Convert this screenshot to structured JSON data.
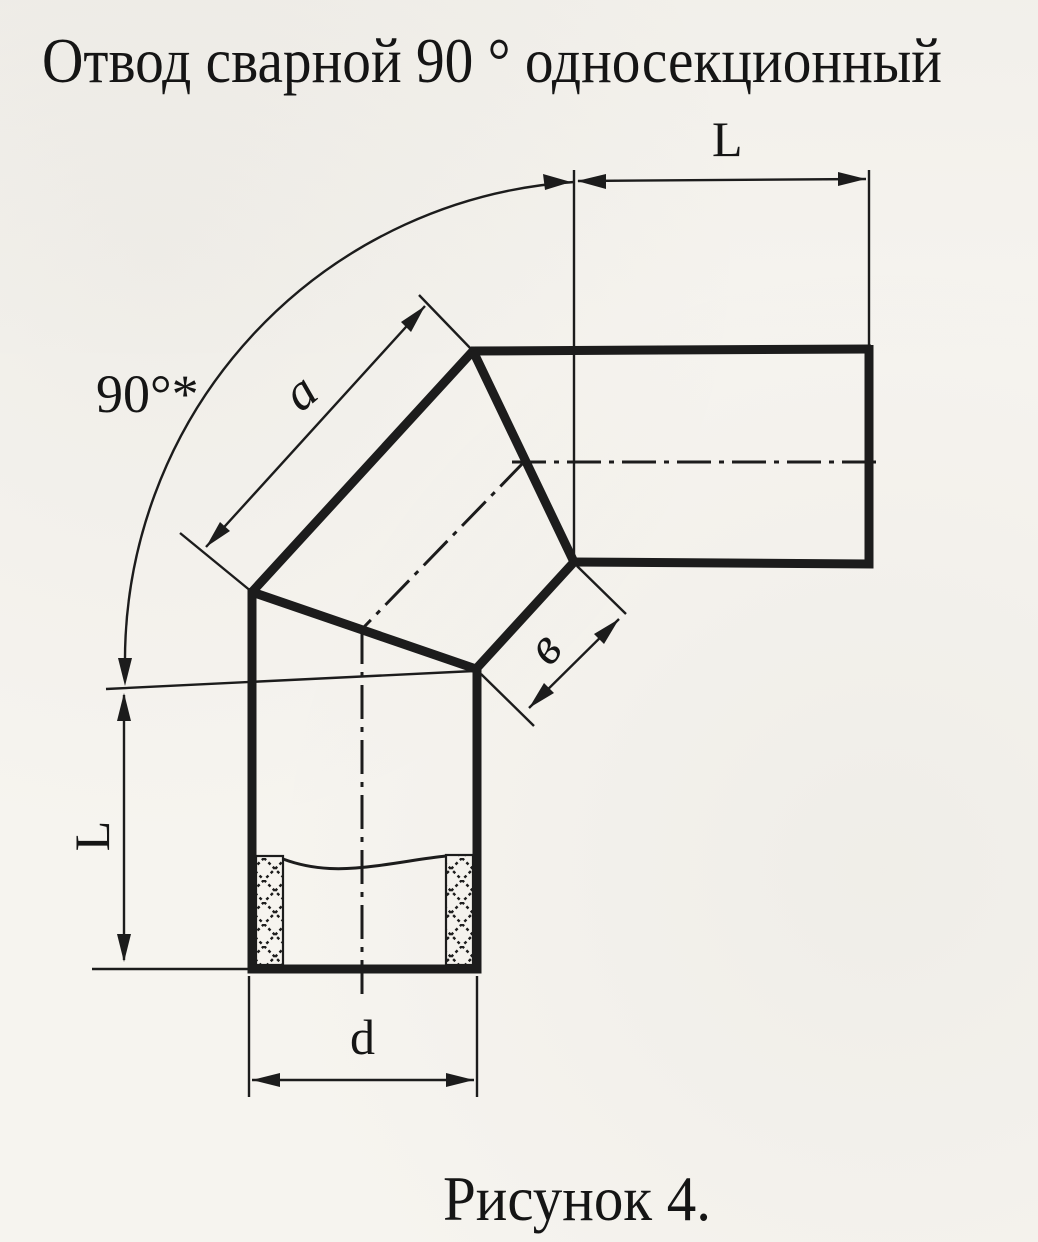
{
  "page": {
    "title": "Отвод сварной 90 ° односекционный",
    "caption": "Рисунок 4.",
    "paper_color": "#f6f4ef",
    "ink_color": "#1c1c1c"
  },
  "dimension_labels": {
    "top_length": "L",
    "left_length": "L",
    "angle": "90°*",
    "section_outer_face": "a",
    "section_inner_face": "в",
    "diameter": "d"
  }
}
